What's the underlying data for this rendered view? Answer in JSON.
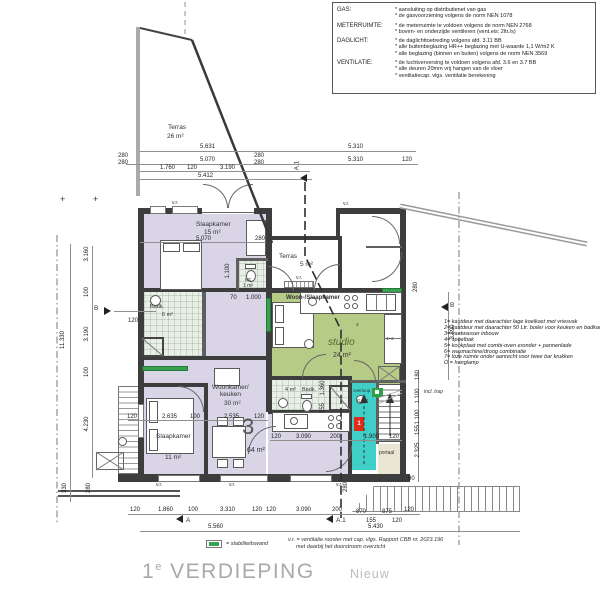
{
  "title": {
    "prefix": "1",
    "sup": "e",
    "word": "VERDIEPING",
    "status": "Nieuw"
  },
  "spec_box": {
    "rows": [
      {
        "label": "GAS:",
        "lines": [
          "* aansluiting op distributienet van gas",
          "* de gasvoorziening volgens de norm NEN 1078"
        ]
      },
      {
        "label": "METERRUIMTE:",
        "lines": [
          "* de meterruimte te voldoen volgens de norm NEN 2768",
          "* boven- en onderzijde ventileren (vent.eis: 2ltr./s)"
        ]
      },
      {
        "label": "DAGLICHT:",
        "lines": [
          "* de daglichttoetreding volgens afd. 3.11 BB",
          "* alle buitenbeglazing HR++ beglazing met U-waarde 1,1 W/m2 K",
          "* alle beglazing (binnen en buiten) volgens de norm NEN 3569"
        ]
      },
      {
        "label": "VENTILATIE:",
        "lines": [
          "* de luchtverversing te voldoen volgens afd. 3.6 en 3.7 BB",
          "* alle deuren 20mm vrij hangen van de vloer",
          "* ventilatiecap. vlgs. ventilatie berekening"
        ]
      }
    ]
  },
  "notes": {
    "items": [
      "1= kastdeur met daarachter lage koelkast met vriesvak",
      "2= kastdeur met daarachter 50 Ltr. boiler voor keuken en badkamer",
      "3= vaatwasser inbouw",
      "4= spoelbak",
      "5= kookplaat met combi-oven eronder + pannenlade",
      "6= wasmachine/droog combinatie",
      "7= loze ruimte onder aanrecht voor twee bar krukken",
      "O = hanglamp"
    ],
    "incl_trap": "incl. trap"
  },
  "rooms": {
    "terras_groot": {
      "name": "Terras",
      "area": "26 m²"
    },
    "slaapkamer_1": {
      "name": "Slaapkamer",
      "area": "15 m²"
    },
    "badkamer_1": {
      "name": "Badk.",
      "area": "6 m²"
    },
    "wc": {
      "name": "wc",
      "area": "1 m²"
    },
    "terras_klein": {
      "name": "Terras",
      "area": "5 m²"
    },
    "woon_slaapkamer": {
      "name": "Woon-/Slaapkamer",
      "sub": "studio",
      "area": "24 m²"
    },
    "badkamer_2": {
      "name": "Badk.",
      "area": "4 m²"
    },
    "overloop": {
      "name": "overloop",
      "area": "6 m²"
    },
    "portaal": {
      "name": "portaal"
    },
    "woonkamer": {
      "name1": "Woonkamer/",
      "name2": "keuken",
      "area": "30 m²"
    },
    "slaapkamer_2": {
      "name": "Slaapkamer",
      "area": "11 m²"
    },
    "appartement": {
      "number": "3",
      "area": "64 m²"
    }
  },
  "kitchen_tags": {
    "t1": "1+2",
    "t2": "3"
  },
  "unit_box": {
    "red": "1"
  },
  "dims": {
    "top": [
      "5.631",
      "5.310",
      "280",
      "280",
      "5.070",
      "280",
      "280",
      "5.310",
      "120",
      "1.760",
      "120",
      "3.190",
      "5.412"
    ],
    "left": [
      "3.160",
      "100",
      "3.190",
      "100",
      "11.330",
      "4.230",
      "120",
      "330",
      "280"
    ],
    "right": [
      "280",
      "3.890",
      "180",
      "1.100",
      "1.100",
      "155",
      "2.325",
      "90"
    ],
    "bottom": [
      "120",
      "1.860",
      "100",
      "3.310",
      "120",
      "120",
      "3.090",
      "200",
      "870",
      "875",
      "120",
      "155",
      "120",
      "5.560",
      "5.430",
      "280"
    ],
    "inner": [
      "5.070",
      "280",
      "1.100",
      "70",
      "1.000",
      "120",
      "2.635",
      "100",
      "2.535",
      "120",
      "120",
      "3.090",
      "200",
      "1.900",
      "120",
      "1.360",
      "155"
    ]
  },
  "markers": {
    "a": "A",
    "a1": "A.1",
    "b_left": "B",
    "b_right": "B",
    "plus": "+"
  },
  "vent_label": "v.r.",
  "legend": {
    "stab": "= stabiliteitswand",
    "note1": "v.r. = ventilatie rooster met cap. vlgs. Rapport CBB nr. 2023.196",
    "note2": "met daarbij het doorstroom overzicht"
  },
  "colors": {
    "lavender": "#d9d5e7",
    "green": "#b6cb85",
    "cyan": "#3fcfc6",
    "tile": "#e9efe7",
    "beige": "#eae6d4",
    "wall": "#3d3d3d",
    "stab": "#3aa052",
    "red": "#df2b18",
    "title": "#a9a9a9"
  }
}
